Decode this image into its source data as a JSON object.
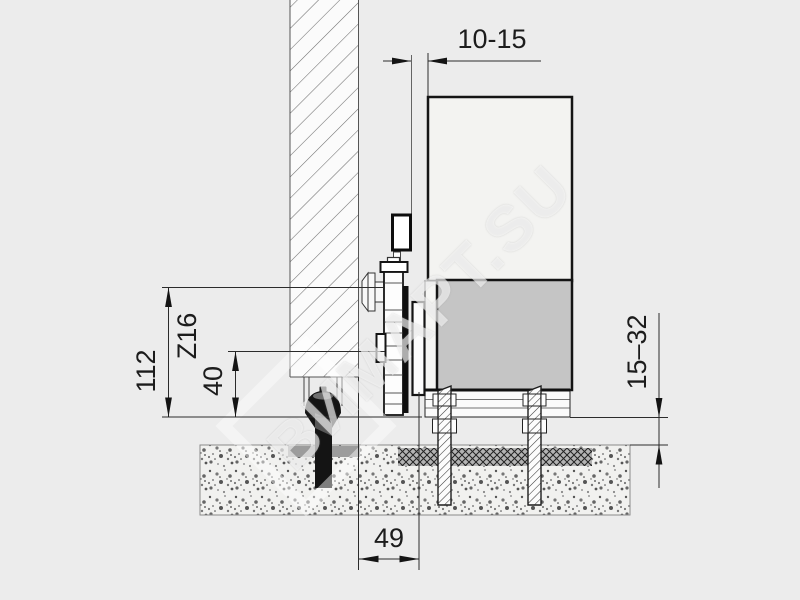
{
  "diagram": {
    "type": "technical-section-drawing",
    "subject": "sliding-door top roller carriage and floor mounting, vertical section",
    "watermark": "ВИМАРТ.SU",
    "dimensions": {
      "door_to_wall_gap": "10-15",
      "total_height": "112",
      "profile_code": "Z16",
      "lower_offset": "40",
      "floor_clearance": "15–32",
      "track_axis_offset": "49"
    },
    "colors": {
      "background": "#ececec",
      "door_panel_light": "#f3f3f1",
      "door_panel_gray": "#c5c5c5",
      "drawing_line": "#141414",
      "floor_plate_gray": "#9c9c9c",
      "bolt_black": "#141414"
    }
  }
}
